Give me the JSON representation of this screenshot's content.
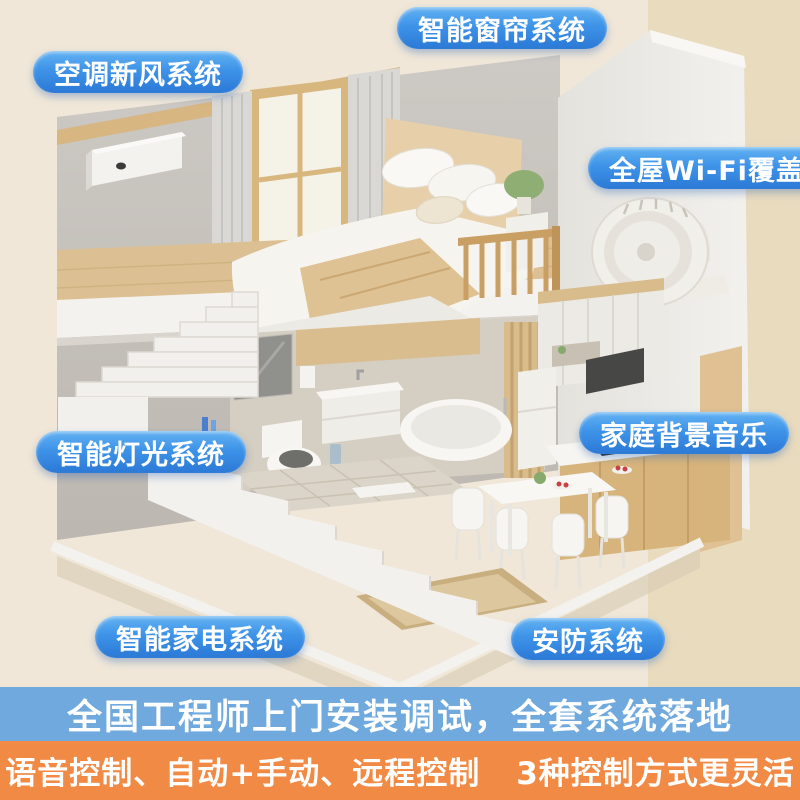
{
  "callouts": [
    {
      "id": "smart-curtain-system",
      "label": "智能窗帘系统"
    },
    {
      "id": "ac-fresh-air-system",
      "label": "空调新风系统"
    },
    {
      "id": "whole-house-wifi",
      "label": "全屋Wi-Fi覆盖"
    },
    {
      "id": "home-background-music",
      "label": "家庭背景音乐"
    },
    {
      "id": "smart-lighting-system",
      "label": "智能灯光系统"
    },
    {
      "id": "smart-appliance-system",
      "label": "智能家电系统"
    },
    {
      "id": "security-system",
      "label": "安防系统"
    }
  ],
  "banners": {
    "installation": "全国工程师上门安装调试，全套系统落地",
    "control_methods": "语音控制、自动+手动、远程控制",
    "control_summary": "3种控制方式更灵活"
  },
  "colors": {
    "pill_blue_top": "#63B2F2",
    "pill_blue_bottom": "#2B79D6",
    "banner_blue": "#6FA9DE",
    "banner_orange": "#F18A44",
    "text_white": "#FFFFFF",
    "background_cream": "#F0E7D8",
    "background_beige": "#E9DBBE"
  },
  "scene_objects": [
    "loft-bedroom",
    "bed",
    "window",
    "curtains",
    "wood-railing",
    "staircase",
    "fresh-air-unit",
    "circulation-fan",
    "bathroom-vanity",
    "mirror",
    "toilet",
    "bathtub",
    "wood-slat-partition",
    "kitchen-cabinets",
    "fridge",
    "range-hood",
    "cooktop",
    "dining-table",
    "chairs",
    "entry-mat",
    "sneakers"
  ]
}
